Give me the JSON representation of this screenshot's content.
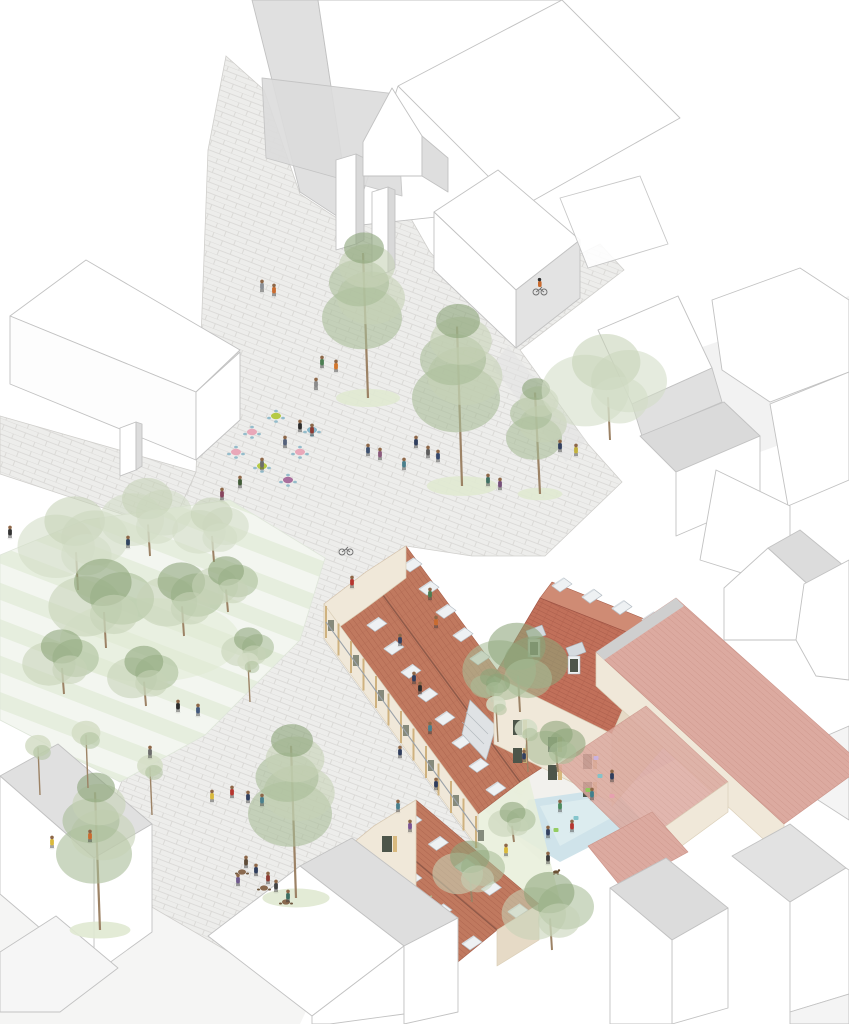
{
  "meta": {
    "description": "Axonometric architectural site illustration: a renovated courtyard block with red tiled roofs and rows of rooflights, a cobblestone public square with pine trees, cafe terraces, a small pool courtyard, surrounded by white context buildings, with many small pedestrians and cyclists"
  },
  "palette": {
    "paper": "#ffffff",
    "context_line": "#c2c2c2",
    "context_fill": "#ffffff",
    "context_shade": "#e0e0e0",
    "context_shade_dark": "#d2d2d2",
    "ground_shadow": "#e8e8e8",
    "cobble_base": "#ededeb",
    "cobble_joint": "#d7d6d3",
    "roof_red": "#c0795f",
    "roof_red_line": "#a65d49",
    "mansard_red": "#c1705a",
    "mansard_red_line": "#9f5546",
    "roof_pink": "#dcaaa0",
    "roof_pink_line": "#cb9489",
    "ridge_brown": "#8f5a49",
    "skylight_fill": "#eef1f3",
    "skylight_line": "#b7bfc6",
    "skylight_shade": "#d5dbe0",
    "facade_cream": "#f0e8d9",
    "facade_cream_dark": "#e6dac6",
    "stone_line": "#dbcfb8",
    "timber": "#cfb27f",
    "window_dark": "#4d554a",
    "shutter_tan": "#d8b97e",
    "balcony_gray": "#9aa1a8",
    "tree_light": "#c6d2b6",
    "tree_mid": "#a9bd97",
    "tree_dark": "#8ba378",
    "tree_pale": "#d3ddc6",
    "trunk": "#9c8265",
    "grass": "#e0e9d2",
    "park_band": "#e6eede",
    "park_base": "#f3f6f0",
    "pool_blue": "#cfe3ea",
    "pool_lavender": "#eae3f3",
    "table_pink": "#e9a8b9",
    "table_lime": "#b6ca44",
    "table_purple": "#a96f9d",
    "table_teal": "#85b5c8",
    "chair_teal": "#8fb9c9",
    "cafe_brown": "#8a6a4f",
    "skin": "#8d6748"
  },
  "scene": {
    "trees": [
      [
        368,
        398,
        100,
        "P"
      ],
      [
        462,
        486,
        110,
        "P"
      ],
      [
        540,
        494,
        70,
        "P"
      ],
      [
        610,
        440,
        95,
        "p"
      ],
      [
        78,
        590,
        84,
        "p"
      ],
      [
        150,
        556,
        70,
        "p"
      ],
      [
        214,
        562,
        58,
        "p"
      ],
      [
        106,
        648,
        80,
        "b"
      ],
      [
        184,
        636,
        66,
        "b"
      ],
      [
        64,
        694,
        58,
        "b"
      ],
      [
        146,
        706,
        54,
        "b"
      ],
      [
        228,
        612,
        50,
        "b"
      ],
      [
        250,
        672,
        40,
        "b"
      ],
      [
        100,
        930,
        95,
        "P"
      ],
      [
        40,
        795,
        34,
        "s"
      ],
      [
        88,
        788,
        38,
        "s"
      ],
      [
        152,
        815,
        34,
        "s"
      ],
      [
        250,
        702,
        28,
        "s"
      ],
      [
        520,
        712,
        80,
        "c"
      ],
      [
        558,
        772,
        46,
        "c"
      ],
      [
        492,
        702,
        30,
        "c"
      ],
      [
        498,
        742,
        26,
        "s"
      ],
      [
        296,
        898,
        105,
        "P"
      ],
      [
        472,
        902,
        55,
        "b"
      ],
      [
        552,
        950,
        70,
        "b"
      ],
      [
        528,
        772,
        30,
        "s"
      ],
      [
        514,
        842,
        36,
        "b"
      ]
    ],
    "people": [
      [
        262,
        292,
        "#8a8f96"
      ],
      [
        274,
        296,
        "#c96b2f"
      ],
      [
        322,
        368,
        "#4c7d52"
      ],
      [
        336,
        372,
        "#d2762c"
      ],
      [
        316,
        390,
        "#8a8a8a"
      ],
      [
        368,
        456,
        "#3c4f6e"
      ],
      [
        380,
        460,
        "#8a5a7c"
      ],
      [
        404,
        470,
        "#4a7f8c"
      ],
      [
        416,
        448,
        "#2f3d5c"
      ],
      [
        428,
        458,
        "#5c5c5c"
      ],
      [
        438,
        462,
        "#36486b"
      ],
      [
        488,
        486,
        "#3f6f63"
      ],
      [
        500,
        490,
        "#754f79"
      ],
      [
        560,
        452,
        "#32405f"
      ],
      [
        576,
        456,
        "#c2b13e"
      ],
      [
        300,
        432,
        "#2d2d2d"
      ],
      [
        312,
        436,
        "#8c3b33"
      ],
      [
        285,
        448,
        "#55617a"
      ],
      [
        262,
        470,
        "#6d6d6d"
      ],
      [
        240,
        488,
        "#405a36"
      ],
      [
        222,
        500,
        "#87455e"
      ],
      [
        128,
        548,
        "#30435f"
      ],
      [
        10,
        538,
        "#333333"
      ],
      [
        178,
        712,
        "#2b2b2b"
      ],
      [
        198,
        716,
        "#43597c"
      ],
      [
        150,
        758,
        "#6b6b6b"
      ],
      [
        52,
        848,
        "#d9b93c"
      ],
      [
        90,
        842,
        "#c96b2f"
      ],
      [
        212,
        802,
        "#d9b93c"
      ],
      [
        232,
        798,
        "#b5352f"
      ],
      [
        248,
        803,
        "#32405f"
      ],
      [
        262,
        806,
        "#4a7f8c"
      ],
      [
        398,
        812,
        "#4a7f8c"
      ],
      [
        410,
        832,
        "#7a5390"
      ],
      [
        436,
        790,
        "#2f3d5c"
      ],
      [
        506,
        856,
        "#d9b93c"
      ],
      [
        548,
        864,
        "#3b3b3b"
      ],
      [
        592,
        800,
        "#3f7f8c"
      ],
      [
        612,
        782,
        "#2f3d5c"
      ],
      [
        572,
        832,
        "#b5352f"
      ],
      [
        548,
        838,
        "#32405f"
      ],
      [
        560,
        812,
        "#4c8a5f"
      ],
      [
        436,
        628,
        "#c96b2f"
      ],
      [
        414,
        684,
        "#32405f"
      ],
      [
        430,
        734,
        "#4a7f8c"
      ],
      [
        400,
        758,
        "#2f3d5c"
      ],
      [
        430,
        600,
        "#4c7d52"
      ],
      [
        400,
        646,
        "#32405f"
      ],
      [
        420,
        694,
        "#2b2b2b"
      ],
      [
        352,
        588,
        "#b5352f"
      ],
      [
        524,
        762,
        "#32405f"
      ],
      [
        246,
        868,
        "#5d4b38"
      ],
      [
        256,
        876,
        "#2f3d5c"
      ],
      [
        268,
        884,
        "#8c3b33"
      ],
      [
        276,
        892,
        "#444444"
      ],
      [
        238,
        886,
        "#6f5a8c"
      ],
      [
        288,
        902,
        "#3f6f63"
      ]
    ],
    "tables": [
      [
        252,
        432,
        "table_pink"
      ],
      [
        276,
        416,
        "table_lime"
      ],
      [
        300,
        452,
        "table_pink"
      ],
      [
        262,
        466,
        "table_lime"
      ],
      [
        236,
        452,
        "table_pink"
      ],
      [
        288,
        480,
        "table_purple"
      ],
      [
        312,
        430,
        "table_teal"
      ]
    ],
    "cafe_tables": [
      [
        242,
        872
      ],
      [
        264,
        888
      ],
      [
        286,
        902
      ]
    ],
    "pool_items": [
      [
        600,
        776,
        "#7fc3c9"
      ],
      [
        588,
        790,
        "#8fca5a"
      ],
      [
        612,
        796,
        "#e7a0b0"
      ],
      [
        576,
        818,
        "#7fc3c9"
      ],
      [
        556,
        830,
        "#8fca5a"
      ],
      [
        596,
        758,
        "#c9b2e0"
      ]
    ],
    "bikes": [
      {
        "x": 540,
        "y": 292,
        "riding": true,
        "jacket": "#c96b2f"
      },
      {
        "x": 346,
        "y": 552,
        "riding": false,
        "jacket": ""
      }
    ],
    "dog": [
      556,
      872
    ],
    "skylight_runs": [
      {
        "layer": "skylights-long-ne",
        "x1": 402,
        "y1": 566,
        "x2": 538,
        "y2": 752,
        "n": 9
      },
      {
        "layer": "skylights-long-sw",
        "x1": 350,
        "y1": 602,
        "x2": 486,
        "y2": 790,
        "n": 9
      },
      {
        "layer": "skylights-gable-ne",
        "x1": 402,
        "y1": 822,
        "x2": 508,
        "y2": 912,
        "n": 5
      },
      {
        "layer": "skylights-gable-sw",
        "x1": 372,
        "y1": 848,
        "x2": 462,
        "y2": 944,
        "n": 4
      },
      {
        "layer": "skylights-mansard-top",
        "x1": 552,
        "y1": 586,
        "x2": 642,
        "y2": 620,
        "n": 4
      }
    ],
    "gallery_posts": {
      "n": 13,
      "x1": 326,
      "y1": 606,
      "x2": 476,
      "y2": 816,
      "drop": 32
    }
  }
}
